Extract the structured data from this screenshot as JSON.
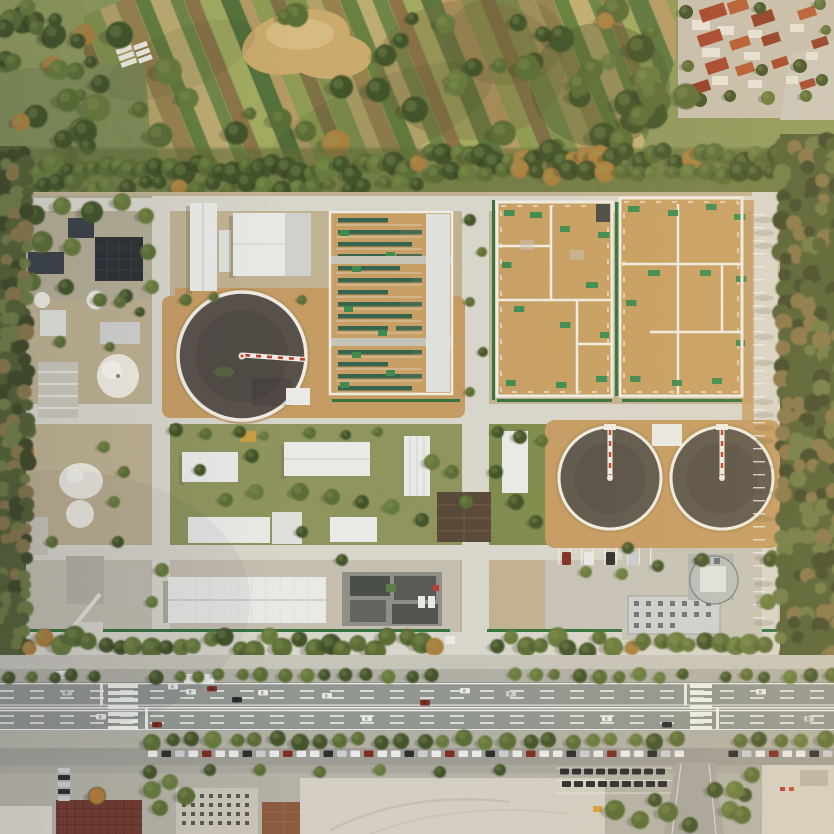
{
  "image": {
    "type": "aerial-photograph",
    "subject": "wastewater-treatment-plant-campus",
    "description": "Top-down drone photograph: strip farmland and a red-roofed village to the north, a walled wastewater treatment plant with three circular clarifiers, rectangular treatment basins, white storage domes and white-roofed service buildings in the middle, woodland strips on the east and west edges, and a wide tree-lined multi-lane boulevard with traffic, crosswalks, parked cars and paved lots along the bottom.",
    "landmarks": {
      "circular_clarifiers": 3,
      "white_storage_domes": 4,
      "rectangular_treatment_basins": 3,
      "tree_medians_on_boulevard": 2,
      "zebra_crosswalks": 2
    }
  },
  "palette": {
    "base_farm": "#8d975c",
    "field_grey": "#7e8a56",
    "dirt": "#c9a96b",
    "dirt_light": "#d8bd85",
    "farm_strips": [
      "#7d8f4a",
      "#b5a267",
      "#96804d",
      "#5f7a3a",
      "#c3ad72",
      "#6b8243",
      "#8a6f45",
      "#a3ab5f",
      "#54703a",
      "#b99a64",
      "#8d9a50",
      "#7b6a42"
    ],
    "tree_dark": "#43532a",
    "tree_main": "#5a6c36",
    "tree_main2": "#66793c",
    "tree_light": "#8f9c55",
    "tree_orange": "#a87e3e",
    "tree_shadow": "#2a331f",
    "belt_base": "#5e6a39",
    "forest_base": "#535f36",
    "forest_dark": "#3f4a2b",
    "forest_light": "#6e7a44",
    "forest_brown": "#85744a",
    "village_ground": "#c6beae",
    "roof_red": "#a5452c",
    "roof_red2": "#b45934",
    "roof_red3": "#8f3b28",
    "village_white": "#e6e2d8",
    "plant_ground": "#c0b190",
    "plant_ground2": "#b3ab94",
    "pavement": "#c5c2b7",
    "road_light": "#d8d5ca",
    "tan_apron": "#c49a62",
    "tan_basin": "#c79e63",
    "hedge": "#35713f",
    "green_patch": "#3f8a4f",
    "lawn": "#7d8a4c",
    "teal_bar": "#35624c",
    "white_roof": "#e9eae6",
    "white_roof2": "#dfe0da",
    "grey_roof": "#cfd0cc",
    "dark_roof": "#2d3134",
    "dark_roof2": "#3a4046",
    "brown_roof": "#584838",
    "water": "#57504a",
    "water2": "#5c564c",
    "rim": "#efece3",
    "bridge_red": "#c23b2e",
    "dome": "#eeeae0",
    "dome_shade": "#cfcabd",
    "asphalt": "#90948e",
    "sidewalk": "#c6c3b8",
    "median_band": "#b0aea3",
    "side_lane": "#9d9b93",
    "marking": "#f2f2ee",
    "lot_pale": "#d3cec2",
    "lot_grey": "#b3b0a4",
    "concrete": "#c9c4b6",
    "maroon": "#6e3a31",
    "maroon_dark": "#5a2e27",
    "tan_bldg": "#8a5a40",
    "grid_dark": "#55584f",
    "car_white": "#e8e8e6",
    "car_dark": "#2d2d2f",
    "car_grey": "#c9ccd0",
    "car_red": "#7c2d24",
    "admin_roof": "#cdd0cf",
    "admin_glass": "#aeb4b2",
    "rust": "#b06a35",
    "equip_yellow": "#d8a13c",
    "shadow": "#6b6450"
  }
}
